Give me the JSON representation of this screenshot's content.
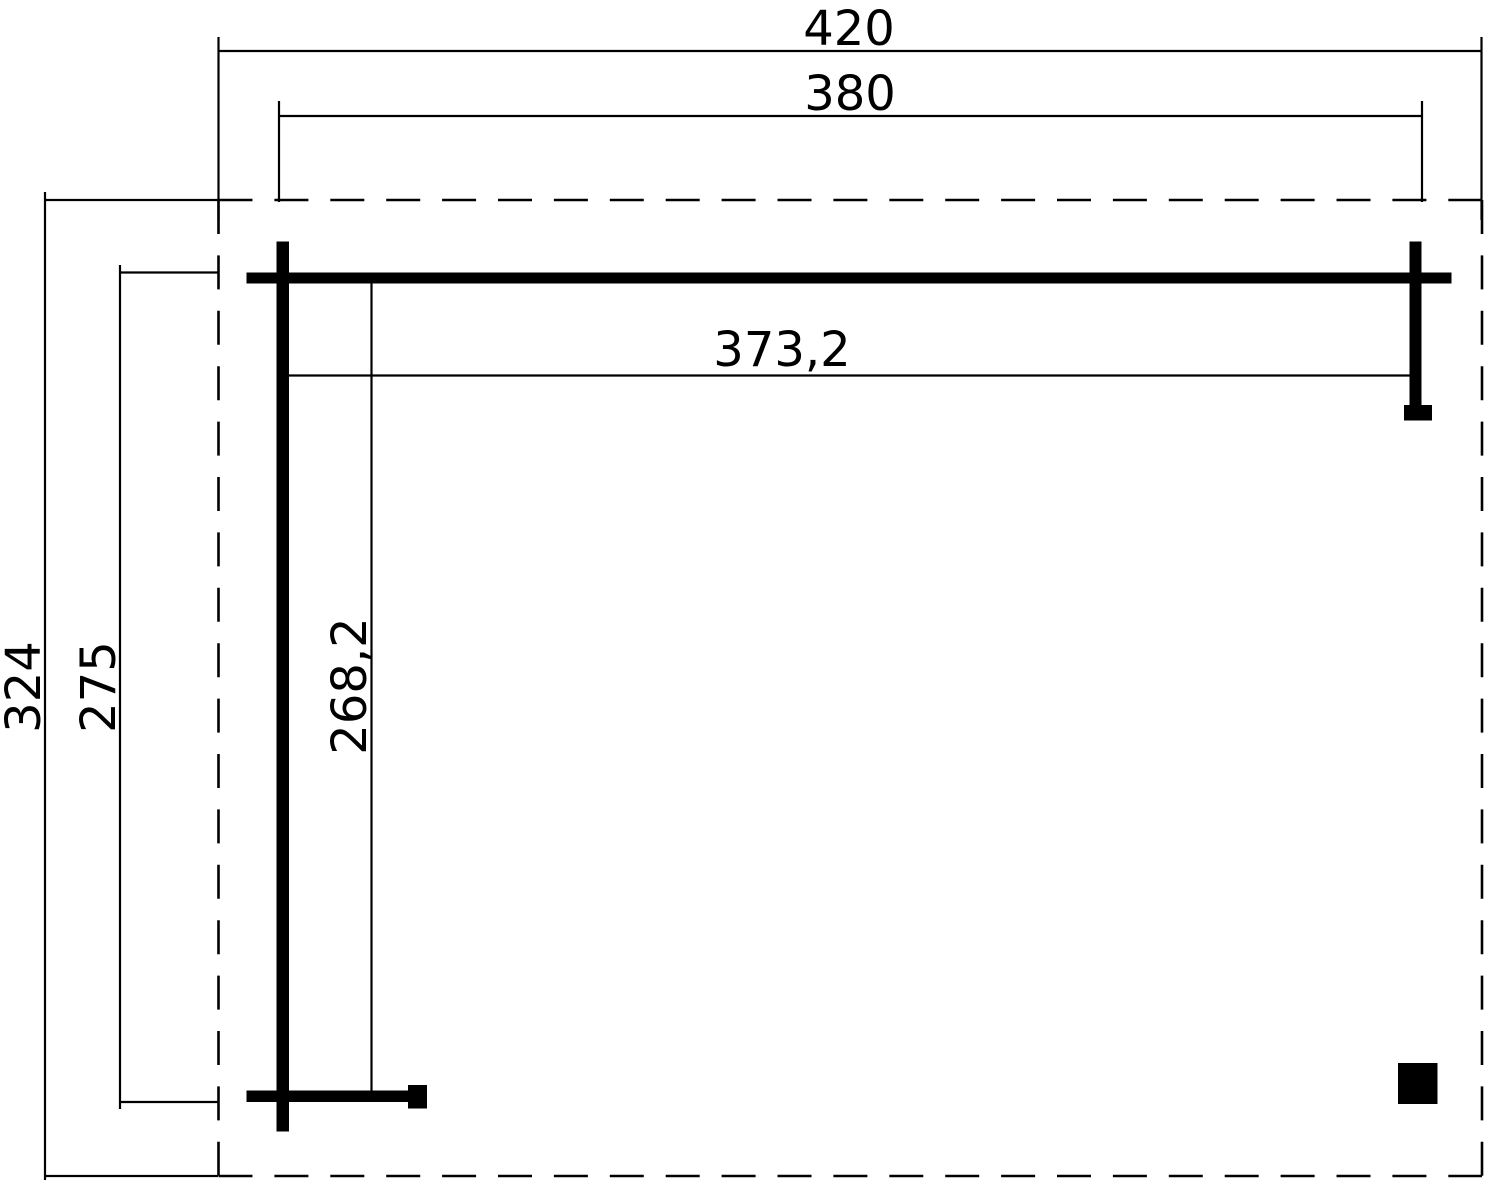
{
  "drawing": {
    "title": "canopy-floor-plan",
    "background_color": "#ffffff",
    "line_color": "#000000",
    "labels": {
      "total_width": "420",
      "canopy_width": "380",
      "total_depth": "324",
      "canopy_depth": "275",
      "inner_width": "373,2",
      "inner_depth": "268,2"
    }
  }
}
